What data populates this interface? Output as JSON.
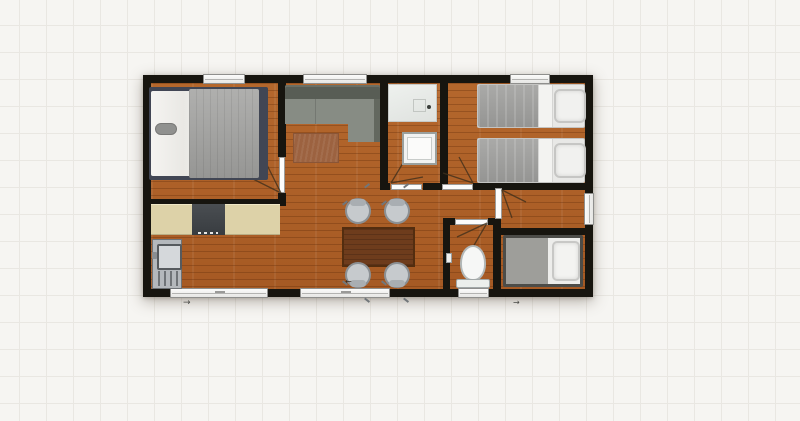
{
  "app": {
    "name": "floor-plan-editor-canvas",
    "visible_text": ""
  },
  "colors": {
    "background": "#f6f5f2",
    "grid_line": "#e9e7e2",
    "wall": "#17150f",
    "floor_wood": "#ae5f26",
    "counter": "#ddd2a8",
    "stove": "#383c40",
    "sofa_seat": "#878c84",
    "sofa_back": "#585d55",
    "rug": "#9c6240",
    "table": "#6e3c1c",
    "chair": "#c6cacd",
    "bed_blanket": "#9e9e9c",
    "bed_linen": "#f2f2f0",
    "master_bed_base": "#414654",
    "fixture_white": "#f2f3f2",
    "door_leaf": "#fcfcfb"
  },
  "icons": {
    "slide_arrow_right": "→",
    "slide_arrow_left": "←"
  },
  "rooms": [
    {
      "name": "master-bedroom"
    },
    {
      "name": "living-area"
    },
    {
      "name": "bathroom"
    },
    {
      "name": "twin-bedroom"
    },
    {
      "name": "kitchen-dining"
    },
    {
      "name": "wc"
    },
    {
      "name": "entry-vestibule"
    },
    {
      "name": "single-bedroom"
    }
  ],
  "furniture": [
    {
      "name": "double-bed"
    },
    {
      "name": "kitchen-counter"
    },
    {
      "name": "stove"
    },
    {
      "name": "kitchen-sink"
    },
    {
      "name": "corner-sofa"
    },
    {
      "name": "rug"
    },
    {
      "name": "dining-table"
    },
    {
      "name": "dining-chair",
      "count": 4
    },
    {
      "name": "single-bed",
      "count": 3
    },
    {
      "name": "shower"
    },
    {
      "name": "washbasin"
    },
    {
      "name": "toilet"
    }
  ]
}
